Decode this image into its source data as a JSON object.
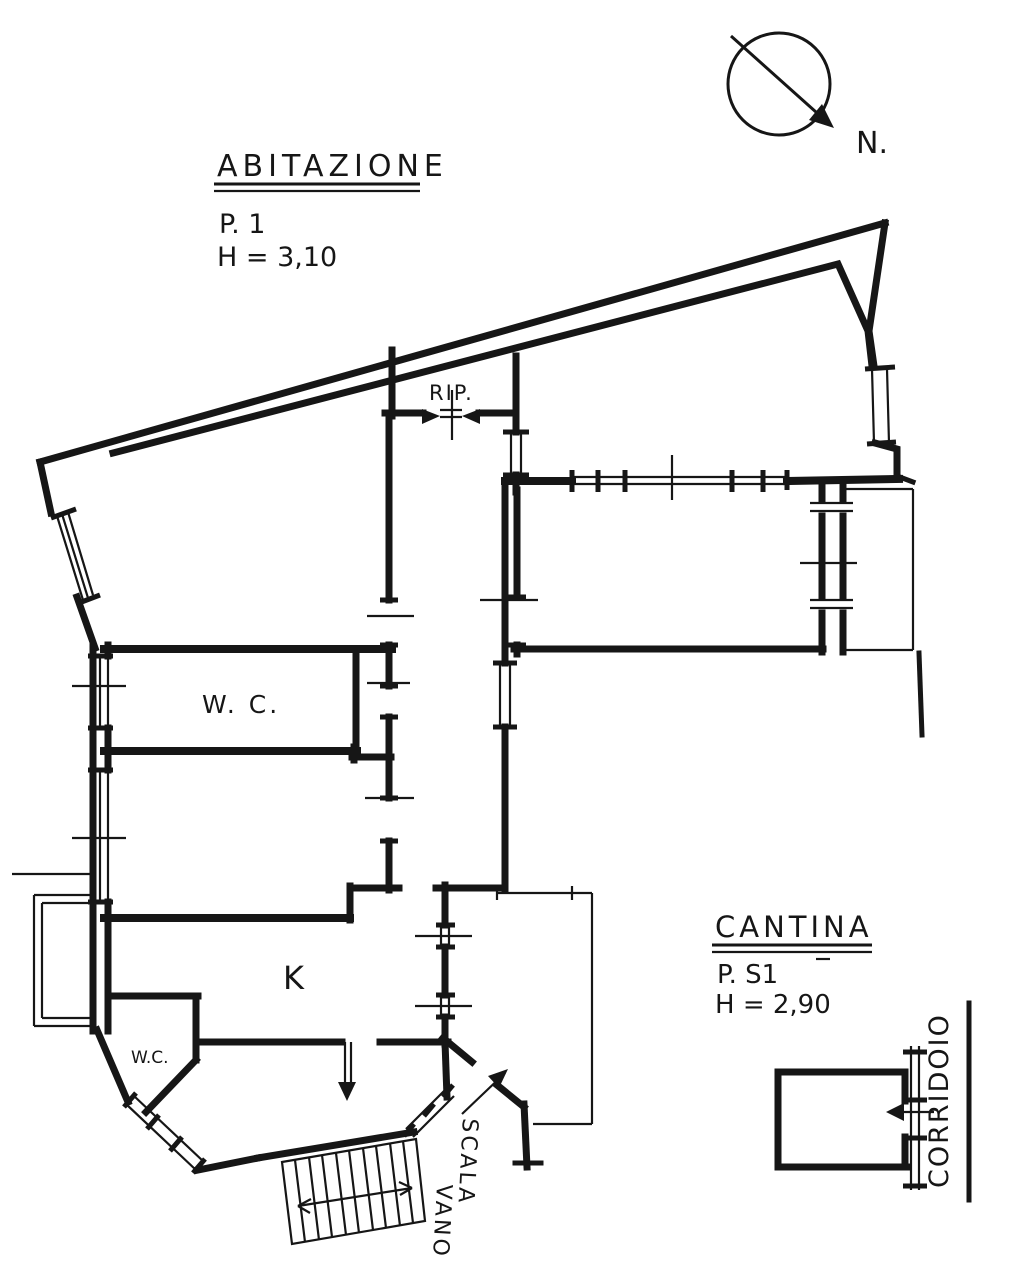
{
  "colors": {
    "ink": "#161616",
    "paper": "#ffffff"
  },
  "apartment_block": {
    "title": "ABITAZIONE",
    "floor": "P. 1",
    "ceiling_height": "H = 3,10"
  },
  "cellar_block": {
    "title": "CANTINA",
    "floor": "P. S1",
    "ceiling_height": "H = 2,90"
  },
  "compass": {
    "label": "N."
  },
  "room_labels": {
    "storage": "RIP.",
    "bathroom_main": "W. C.",
    "kitchen": "K",
    "bathroom_small": "W.C.",
    "stairwell_word_1": "VANO",
    "stairwell_word_2": "SCALA",
    "corridor": "CORRIDOIO"
  }
}
